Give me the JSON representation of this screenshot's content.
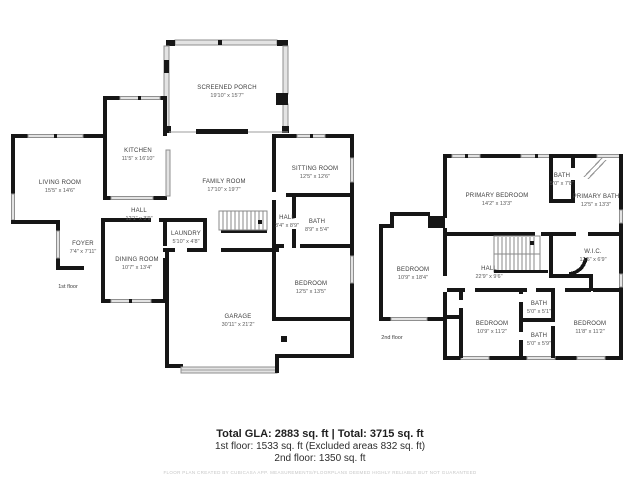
{
  "floor1": {
    "caption": "1st floor",
    "rooms": {
      "screened_porch": {
        "name": "SCREENED PORCH",
        "dims": "19'10\" x 15'7\""
      },
      "kitchen": {
        "name": "KITCHEN",
        "dims": "11'5\" x 16'10\""
      },
      "living_room": {
        "name": "LIVING ROOM",
        "dims": "15'5\" x 14'6\""
      },
      "family_room": {
        "name": "FAMILY ROOM",
        "dims": "17'10\" x 19'7\""
      },
      "sitting_room": {
        "name": "SITTING ROOM",
        "dims": "12'5\" x 12'6\""
      },
      "hall": {
        "name": "HALL",
        "dims": "12'1\" x 3'9\""
      },
      "foyer": {
        "name": "FOYER",
        "dims": "7'4\" x 7'11\""
      },
      "dining_room": {
        "name": "DINING ROOM",
        "dims": "10'7\" x 13'4\""
      },
      "laundry": {
        "name": "LAUNDRY",
        "dims": "5'10\" x 4'8\""
      },
      "hall2": {
        "name": "HALL",
        "dims": "3'4\" x 8'9\""
      },
      "bath": {
        "name": "BATH",
        "dims": "8'9\" x 5'4\""
      },
      "bedroom": {
        "name": "BEDROOM",
        "dims": "12'5\" x 13'5\""
      },
      "garage": {
        "name": "GARAGE",
        "dims": "30'11\" x 21'2\""
      }
    }
  },
  "floor2": {
    "caption": "2nd floor",
    "rooms": {
      "primary_bedroom": {
        "name": "PRIMARY BEDROOM",
        "dims": "14'2\" x 13'3\""
      },
      "bath_small": {
        "name": "BATH",
        "dims": "5'0\" x 7'8\""
      },
      "primary_bath": {
        "name": "PRIMARY BATH",
        "dims": "12'5\" x 13'3\""
      },
      "wic": {
        "name": "W.I.C.",
        "dims": "12'5\" x 6'9\""
      },
      "hall": {
        "name": "HALL",
        "dims": "22'9\" x 9'6\""
      },
      "bedroom_left": {
        "name": "BEDROOM",
        "dims": "10'9\" x 18'4\""
      },
      "bath_top": {
        "name": "BATH",
        "dims": "5'0\" x 5'1\""
      },
      "bedroom_mid": {
        "name": "BEDROOM",
        "dims": "10'9\" x 11'2\""
      },
      "bath_bottom": {
        "name": "BATH",
        "dims": "5'0\" x 5'9\""
      },
      "bedroom_right": {
        "name": "BEDROOM",
        "dims": "11'8\" x 11'2\""
      }
    }
  },
  "footer": {
    "line1": "Total GLA: 2883 sq. ft | Total: 3715 sq. ft",
    "line2": "1st floor: 1533 sq. ft (Excluded areas 832 sq. ft)",
    "line3": "2nd floor: 1350 sq. ft",
    "disclaimer": "FLOOR PLAN CREATED BY CUBICASA APP. MEASUREMENTS/FLOORPLANS DEEMED HIGHLY RELIABLE BUT NOT GUARANTEED"
  }
}
